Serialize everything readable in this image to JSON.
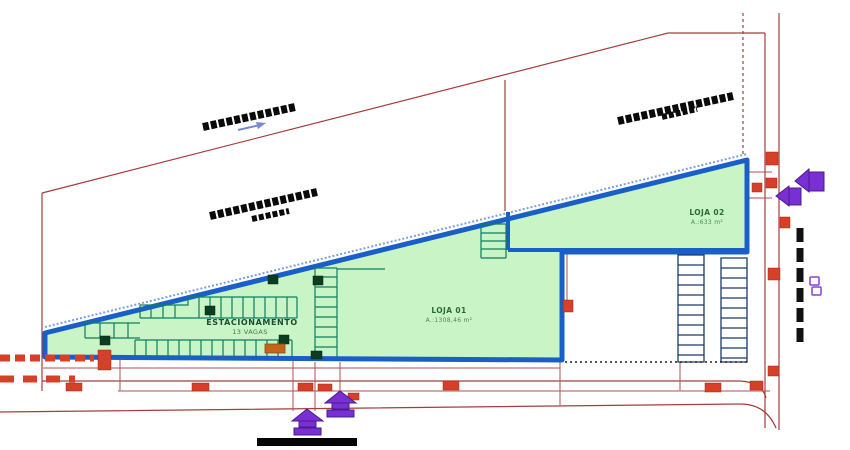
{
  "drawing": {
    "type": "architectural-site-plan",
    "building": {
      "parking_label": "ESTACIONAMENTO",
      "parking_spaces_label": "13 VAGAS",
      "units": [
        {
          "name": "LOJA 01",
          "area": "A.:1308,46 m²"
        },
        {
          "name": "LOJA 02",
          "area": "A.:633 m²"
        }
      ]
    },
    "colors": {
      "building_fill": "#c9f4c6",
      "building_outline": "#1a5fc8",
      "stall_line": "#0e7d62",
      "exterior_stall_line": "#1b3a6b",
      "boundary_red": "#a63d3d",
      "marker_red": "#d64028",
      "symbol_purple": "#7a2fd6",
      "loading_orange": "#c2641c",
      "street_label_black": "#0a0a0a",
      "label_green": "#1b4d2e"
    },
    "icons": [
      "street-label-bar",
      "direction-arrow-icon",
      "entrance-arrow-icon",
      "access-canopy-icon",
      "door-swing-icon",
      "scale-bar"
    ]
  }
}
